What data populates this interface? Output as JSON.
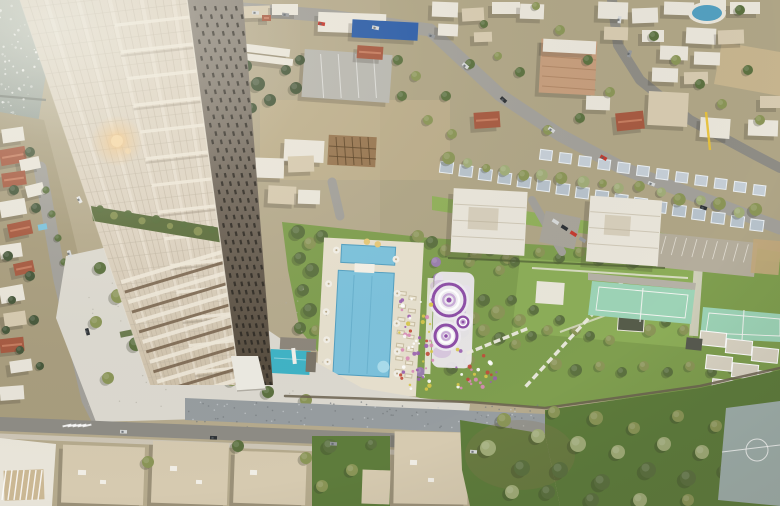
{
  "meta": {
    "width": 780,
    "height": 506,
    "kind": "aerial-architectural-rendering",
    "subject": "Aerial rendering of a residential high-rise tower beside the sea with landscaped podium gardens, swimming pools, purple play spirals, tennis courts, lawns and surrounding low-rise city"
  },
  "palette": {
    "ground": "#b5aa8d",
    "ground2": "#a89d7e",
    "dirt": "#c6b48e",
    "sea_top": "#b6bdb2",
    "sea_bot": "#7f8c86",
    "foam": "#ffffff",
    "breakwater": "#6e756d",
    "road": "#a2a09a",
    "road_dark": "#8e8c85",
    "sidewalk": "#cfc9ba",
    "plaza": "#dcd9d0",
    "plaza_dot": "#b3afa4",
    "gravel": "#979da0",
    "gravel_light": "#c6cbcd",
    "gravel_dark": "#757b7e",
    "lawn": "#7f9e4f",
    "lawn_bright": "#90b05a",
    "lawn_dark": "#5e7c3c",
    "tree_dark": "#46573a",
    "tree_green": "#5c7140",
    "tree_olive": "#8a9557",
    "tree_sage": "#a0ac78",
    "tree_purple": "#9a7fae",
    "tree_shadow": "#3a3d2c",
    "pool": "#7cc2dc",
    "pool_dark": "#539fc0",
    "pool_light": "#a9dcec",
    "water_feature": "#3fb3c6",
    "deck": "#e7e0ce",
    "lounge": "#f0ead8",
    "lounge_edge": "#c9bfa4",
    "purple": "#8e4fa8",
    "purple_light": "#c9abd8",
    "purple_pale": "#f0ecf2",
    "court": "#9dd3b6",
    "court_line": "#f2f4f0",
    "slab": "#d9d3c3",
    "sport": "#9fafab",
    "wall": "#6b6150",
    "stone": "#8d867b",
    "cream1": "#ddd3c2",
    "cream2": "#cfc2ab",
    "mullion": "#b2a692",
    "floorline": "#c2b8a6",
    "band_white": "#efe8da",
    "band_brown": "#7b6750",
    "glass": "#8e8270",
    "dark1": "#8b847a",
    "dark2": "#6e6458",
    "dark3": "#544a3c",
    "slot": "#2c2822",
    "edge_hi": "#f0e9da",
    "canopy": "#edebe3",
    "terrace": "#5e7040",
    "bldg_white": "#e9e5da",
    "bldg_beige": "#d6cab0",
    "roof_red": "#a65a41",
    "roof_red_hi": "#c97f63",
    "blue_store": "#2f5fa8",
    "warehouse": "#b8b7b0",
    "constr_tan": "#c59d7c",
    "steel": "#96744f",
    "steel_dark": "#5c4428",
    "row_a": "#b7c2cb",
    "row_b": "#c5ced6",
    "row_edge": "#e9eef2",
    "shadow": "#3c382e",
    "flare": "#f5c47e",
    "flower_colors": [
      "#c24b3a",
      "#d98bb8",
      "#ffffff",
      "#9a5fb0",
      "#d8c84a"
    ],
    "car_colors": [
      "#d6d8d8",
      "#2e3236",
      "#c43a30",
      "#96999c",
      "#e8e8e6"
    ]
  },
  "scene": {
    "seed": 11,
    "counts": {
      "sea_sparkles": 90,
      "plaza_speckle": 70,
      "gravel_dots": 90,
      "flowers_a": 56,
      "flowers_b": 26,
      "slot_rows": 46,
      "slot_cols": 5,
      "mullions": 22,
      "floors": 29,
      "podium_stripes": 13
    },
    "features": [
      "sea",
      "coastal-town",
      "city-north",
      "rowhouse-band",
      "apartment-blocks",
      "podium-garden",
      "pool-deck",
      "swimming-pool",
      "play-spirals",
      "tennis-courts",
      "parking-lot",
      "sport-court",
      "grove",
      "plaza",
      "perimeter-wall",
      "bottom-rooftops",
      "tower-light-facade",
      "tower-dark-facade",
      "sun-flare"
    ]
  }
}
